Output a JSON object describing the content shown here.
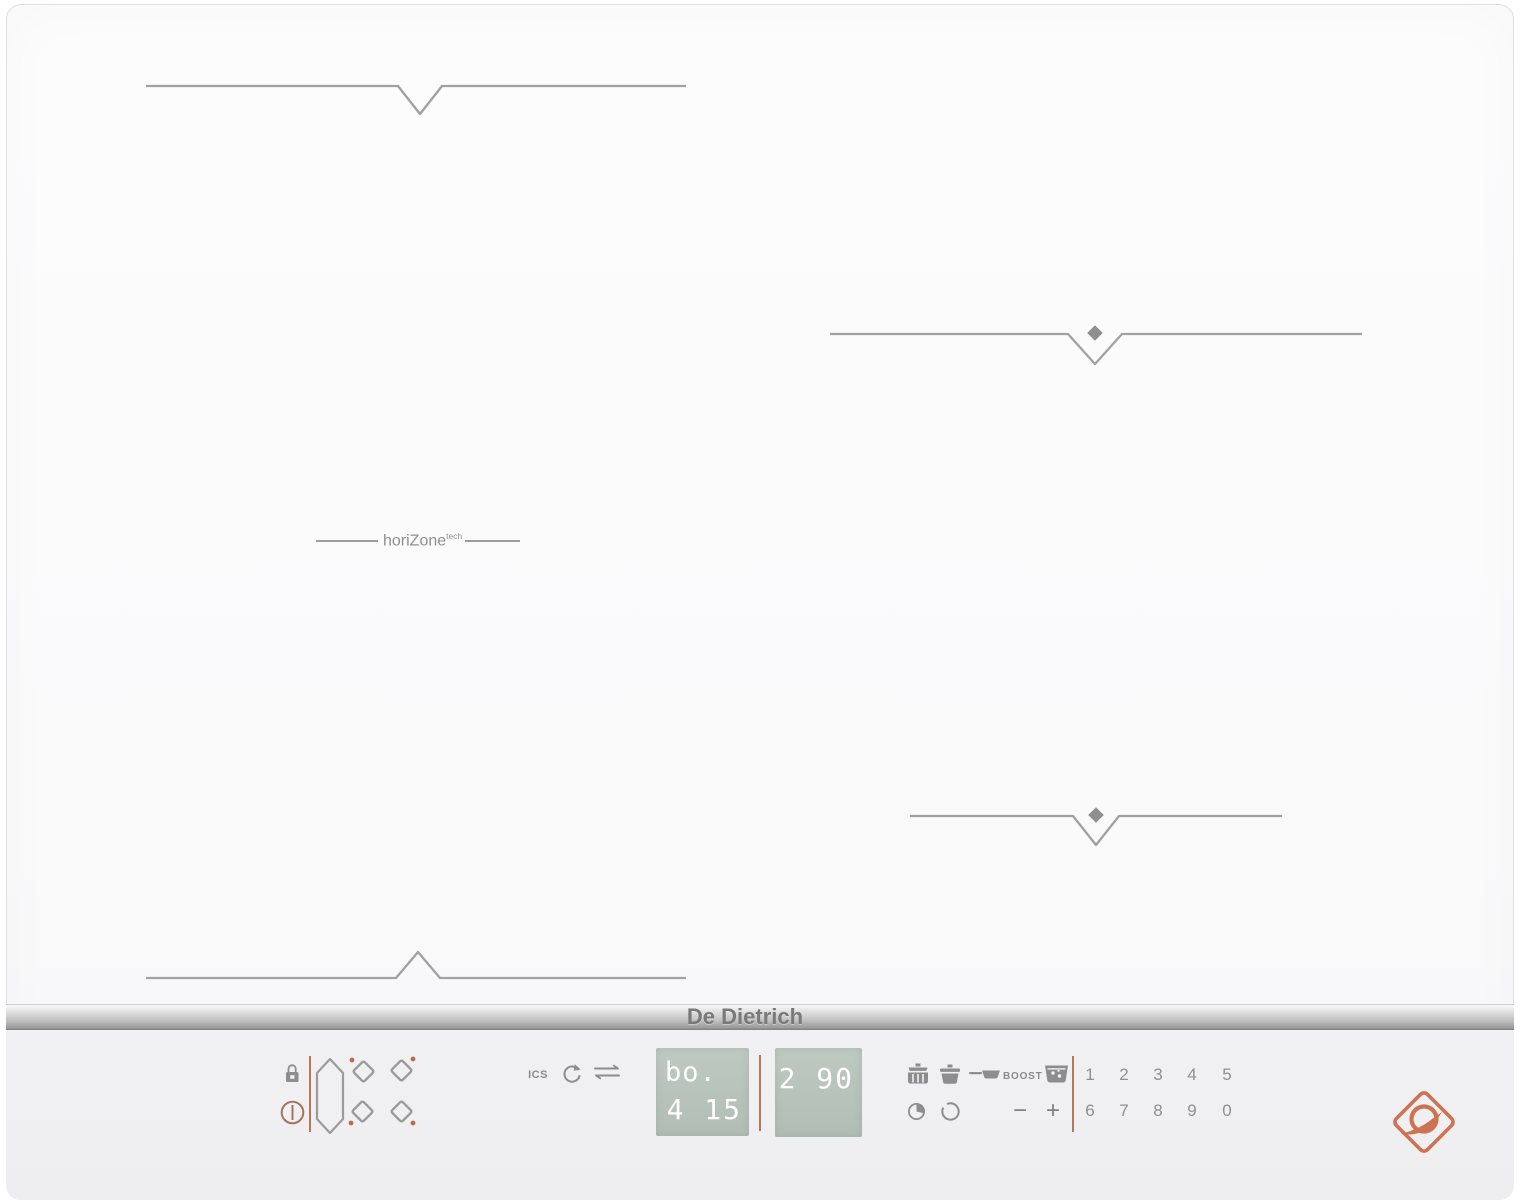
{
  "brand": {
    "name": "De Dietrich",
    "logo_color": "#cd7352"
  },
  "surface": {
    "technology_label": {
      "name": "horiZone",
      "sup": "tech"
    },
    "marker_color": "#a1a1a1",
    "zones": [
      {
        "id": "rear-left-horizone-zone",
        "marker": "v-notch"
      },
      {
        "id": "right-rear-zone",
        "marker": "v-notch-with-diamond"
      },
      {
        "id": "right-front-zone",
        "marker": "v-notch-with-diamond"
      },
      {
        "id": "front-left-horizone-zone",
        "marker": "caret-notch"
      }
    ]
  },
  "panel": {
    "background": "#f0f0f2",
    "accent_color": "#b5765a",
    "icon_color": "#8d8d8d",
    "ics_label": "ICS",
    "boost_label": "BOOST",
    "minus_label": "−",
    "plus_label": "+",
    "displays": {
      "background": "#b8c3bc",
      "text_color": "#ffffff",
      "left": {
        "line1": "bo.",
        "line2": "4 15"
      },
      "right": {
        "line1": "2 90"
      }
    },
    "keypad": {
      "row1": [
        "1",
        "2",
        "3",
        "4",
        "5"
      ],
      "row2": [
        "6",
        "7",
        "8",
        "9",
        "0"
      ]
    },
    "icons": [
      "lock-icon",
      "power-icon",
      "full-zone-key-icon",
      "zone-rear-left-key-icon",
      "zone-rear-right-key-icon",
      "zone-front-left-key-icon",
      "zone-front-right-key-icon",
      "refresh-icon",
      "transfer-icon",
      "steam-pot-icon",
      "pot-icon",
      "frying-pan-icon",
      "deep-fryer-icon",
      "elapsed-time-icon",
      "ring-icon",
      "de-dietrich-horn-logo"
    ]
  }
}
